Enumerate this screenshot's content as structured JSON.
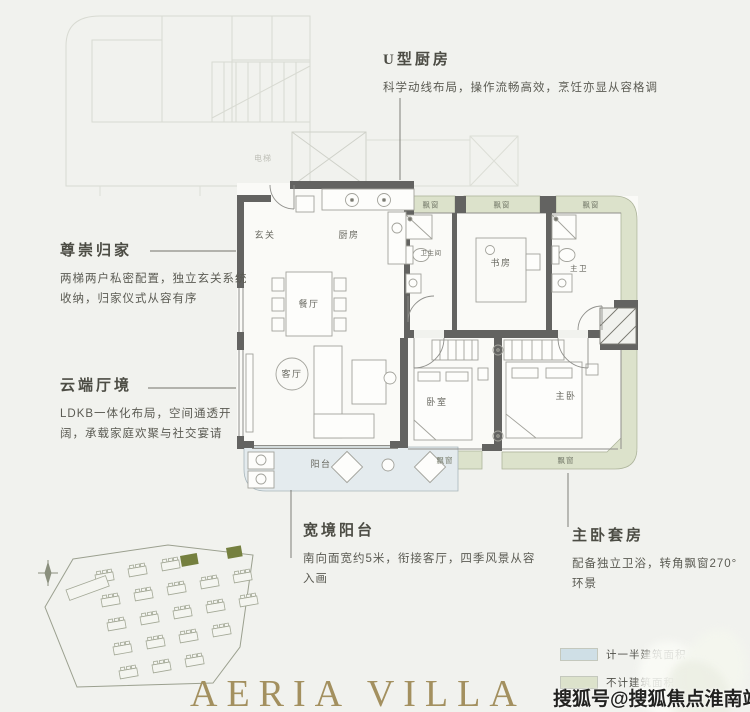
{
  "page": {
    "background": "#f1f2ee"
  },
  "colors": {
    "wall": "#636361",
    "bay_window_fill": "#dce2cb",
    "balcony_fill": "#e4ebee",
    "site_highlight": "#75803f",
    "brand_gold": "#a3905f"
  },
  "annotations": {
    "kitchen": {
      "title": "U型厨房",
      "desc": "科学动线布局，操作流畅高效，烹饪亦显从容格调"
    },
    "entry": {
      "title": "尊崇归家",
      "desc": "两梯两户私密配置，独立玄关系统收纳，归家仪式从容有序"
    },
    "living": {
      "title": "云端厅境",
      "desc": "LDKB一体化布局，空间通透开阔，承载家庭欢聚与社交宴请"
    },
    "balcony": {
      "title": "宽境阳台",
      "desc": "南向面宽约5米，衔接客厅，四季风景从容入画"
    },
    "master": {
      "title": "主卧套房",
      "desc": "配备独立卫浴，转角飘窗270°环景"
    }
  },
  "rooms": {
    "foyer": "玄关",
    "kitchen": "厨房",
    "dining": "餐厅",
    "living": "客厅",
    "balcony": "阳台",
    "bathroom": "卫生间",
    "study": "书房",
    "master_bath": "主卫",
    "bedroom": "卧室",
    "master_bedroom": "主卧",
    "bay_window": "飘窗",
    "elevator": "电梯"
  },
  "legend": {
    "items": [
      {
        "label": "计一半建筑面积",
        "color": "#cfdfe6"
      },
      {
        "label": "不计建筑面积",
        "color": "#dce2cb"
      }
    ]
  },
  "brand": {
    "name": "AERIA VILLA"
  },
  "watermark": {
    "text": "搜狐号@搜狐焦点淮南站"
  }
}
